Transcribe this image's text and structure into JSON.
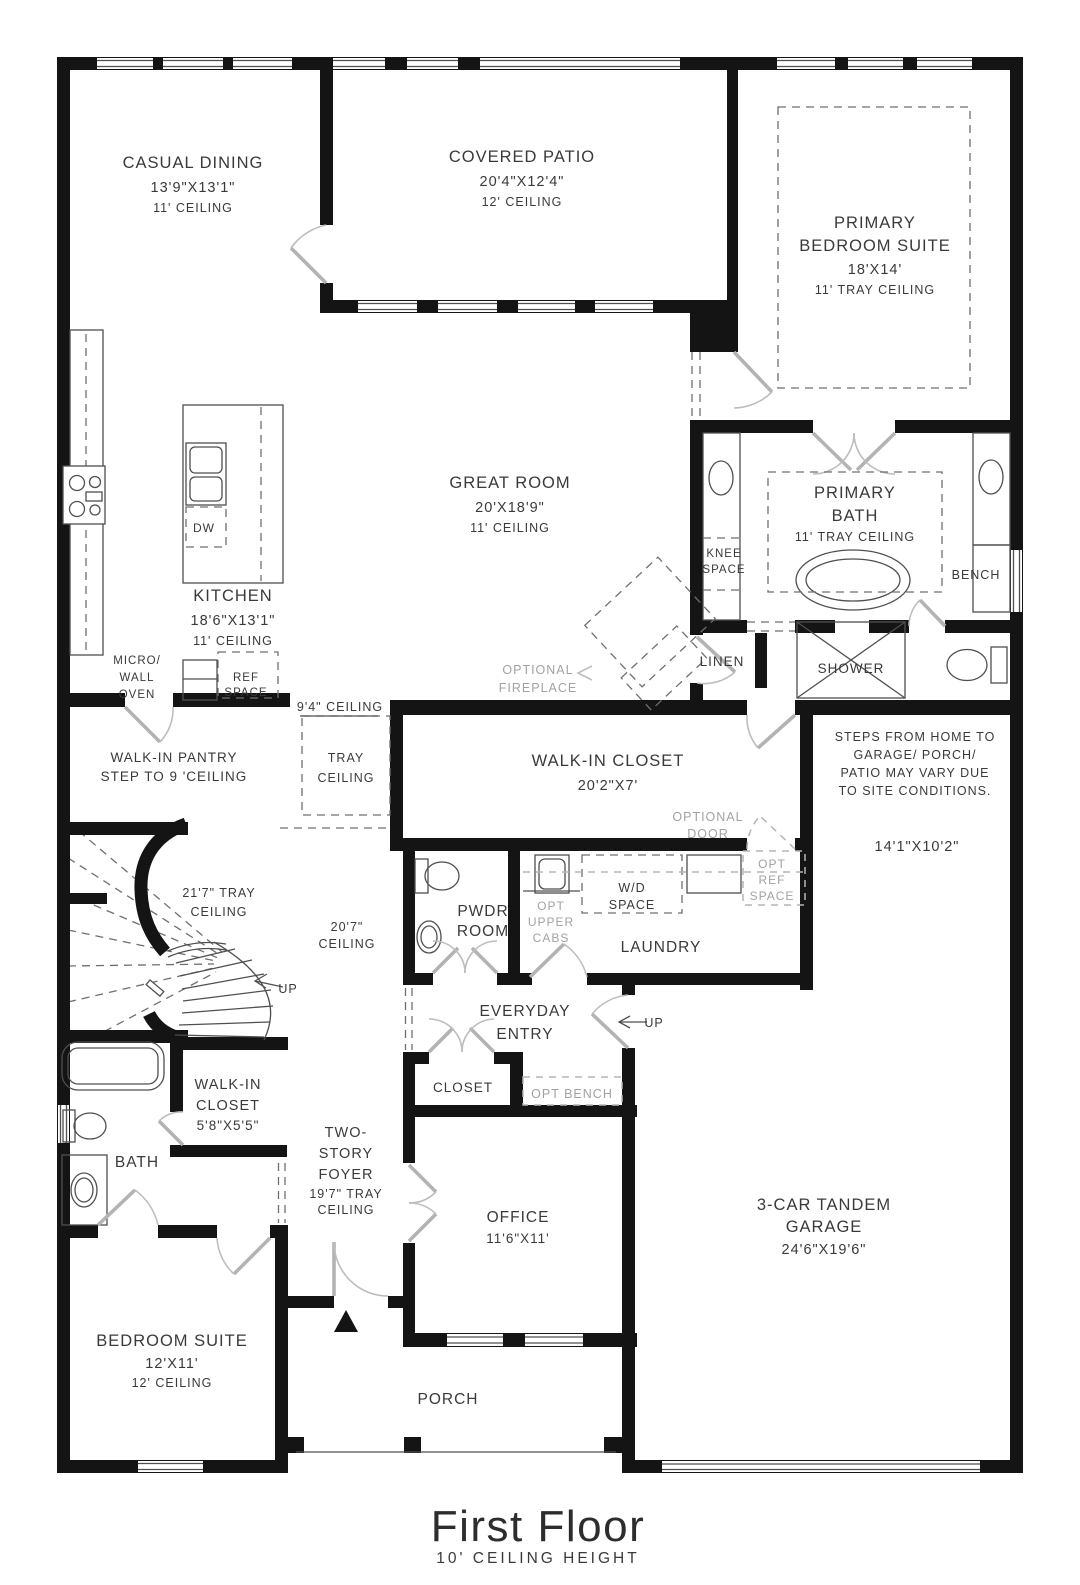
{
  "title": {
    "name": "First Floor",
    "subtitle": "10' CEILING HEIGHT"
  },
  "colors": {
    "wall": "#141414",
    "thin_line": "#4f4f4f",
    "door_swing": "#b5b5b5",
    "dashed_dark": "#6f6f6f",
    "dashed_gray": "#b5b5b5",
    "label_text": "#3a3a3a",
    "optional_text": "#a2a2a2"
  },
  "rooms": {
    "casual_dining": {
      "name": "CASUAL DINING",
      "dim": "13'9\"X13'1\"",
      "ceiling": "11' CEILING"
    },
    "covered_patio": {
      "name": "COVERED PATIO",
      "dim": "20'4\"X12'4\"",
      "ceiling": "12' CEILING"
    },
    "primary_bedroom": {
      "name1": "PRIMARY",
      "name2": "BEDROOM SUITE",
      "dim": "18'X14'",
      "ceiling": "11' TRAY CEILING"
    },
    "great_room": {
      "name": "GREAT ROOM",
      "dim": "20'X18'9\"",
      "ceiling": "11' CEILING"
    },
    "kitchen": {
      "name": "KITCHEN",
      "dim": "18'6\"X13'1\"",
      "ceiling": "11' CEILING"
    },
    "primary_bath": {
      "name1": "PRIMARY",
      "name2": "BATH",
      "ceiling": "11' TRAY CEILING"
    },
    "walk_in_closet": {
      "name": "WALK-IN CLOSET",
      "dim": "20'2\"X7'"
    },
    "walk_in_pantry": {
      "line1": "WALK-IN PANTRY",
      "line2": "STEP TO 9 'CEILING"
    },
    "powder_room": {
      "name1": "PWDR",
      "name2": "ROOM"
    },
    "laundry": {
      "name": "LAUNDRY"
    },
    "everyday_entry": {
      "name1": "EVERYDAY",
      "name2": "ENTRY"
    },
    "closet": {
      "name": "CLOSET"
    },
    "small_walk_in_closet": {
      "name1": "WALK-IN",
      "name2": "CLOSET",
      "dim": "5'8\"X5'5\""
    },
    "bath": {
      "name": "BATH"
    },
    "foyer": {
      "name1": "TWO-",
      "name2": "STORY",
      "name3": "FOYER",
      "dim": "19'7\" TRAY",
      "ceiling": "CEILING"
    },
    "bedroom_suite": {
      "name": "BEDROOM SUITE",
      "dim": "12'X11'",
      "ceiling": "12' CEILING"
    },
    "office": {
      "name": "OFFICE",
      "dim": "11'6\"X11'"
    },
    "garage": {
      "name1": "3-CAR TANDEM",
      "name2": "GARAGE",
      "dim": "24'6\"X19'6\""
    },
    "porch": {
      "name": "PORCH"
    },
    "linen": {
      "name": "LINEN"
    },
    "shower": {
      "name": "SHOWER"
    }
  },
  "annotations": {
    "knee_space": {
      "line1": "KNEE",
      "line2": "SPACE"
    },
    "bench": "BENCH",
    "optional_fireplace": {
      "line1": "OPTIONAL",
      "line2": "FIREPLACE"
    },
    "ceiling_9_4": "9'4\" CEILING",
    "tray_ceiling": {
      "line1": "TRAY",
      "line2": "CEILING"
    },
    "steps_note": {
      "line1": "STEPS FROM HOME TO",
      "line2": "GARAGE/ PORCH/",
      "line3": "PATIO MAY VARY DUE",
      "line4": "TO SITE CONDITIONS."
    },
    "garage_hall_dim": "14'1\"X10'2\"",
    "optional_door": {
      "line1": "OPTIONAL",
      "line2": "DOOR"
    },
    "opt_ref_space": {
      "line1": "OPT",
      "line2": "REF",
      "line3": "SPACE"
    },
    "wd_space": {
      "line1": "W/D",
      "line2": "SPACE"
    },
    "opt_upper_cabs": {
      "line1": "OPT",
      "line2": "UPPER",
      "line3": "CABS"
    },
    "opt_bench": "OPT BENCH",
    "tray_21_7": {
      "line1": "21'7\" TRAY",
      "line2": "CEILING"
    },
    "ceiling_20_7": {
      "line1": "20'7\"",
      "line2": "CEILING"
    },
    "up_stairs": "UP",
    "up_garage": "UP",
    "micro_wall_oven": {
      "line1": "MICRO/",
      "line2": "WALL",
      "line3": "OVEN"
    },
    "ref_space": {
      "line1": "REF",
      "line2": "SPACE"
    },
    "dishwasher": "DW"
  }
}
